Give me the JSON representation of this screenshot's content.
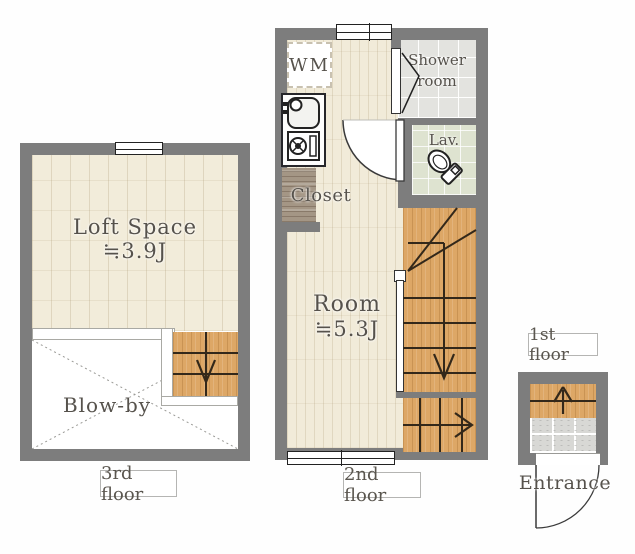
{
  "title": "Apartment floor plan",
  "labels": {
    "loft_title": "Loft Space",
    "loft_size": "≒3.9J",
    "blow_by": "Blow-by",
    "wm": "WM",
    "shower_line1": "Shower",
    "shower_line2": "room",
    "lav": "Lav.",
    "closet": "Closet",
    "room_title": "Room",
    "room_size": "≒5.3J",
    "entrance": "Entrance"
  },
  "captions": {
    "floor3": "3rd floor",
    "floor2": "2nd floor",
    "floor1": "1st floor"
  },
  "icons": {
    "stairs_down_arrow": "↓",
    "stairs_right_arrow": "→",
    "stairs_up_arrow": "↑",
    "window": "double-line window symbol",
    "door_swing": "quarter-circle door swing",
    "folding_door": "chevron folding door",
    "cross_brace": "dotted X void marker",
    "toilet": "toilet plan symbol",
    "kitchen_sink": "sink with faucet",
    "gas_stove": "single burner stove"
  },
  "colors": {
    "wall": "#7d7d7d",
    "floor_plank": "#f1ebd9",
    "stair_wood": "#dda766",
    "shower_tile": "#e3e3df",
    "lav_tile": "#dee3d0",
    "closet": "#a49685",
    "entrance_stone": "#d8d8d5",
    "line": "#33281a",
    "text": "#56524c"
  }
}
